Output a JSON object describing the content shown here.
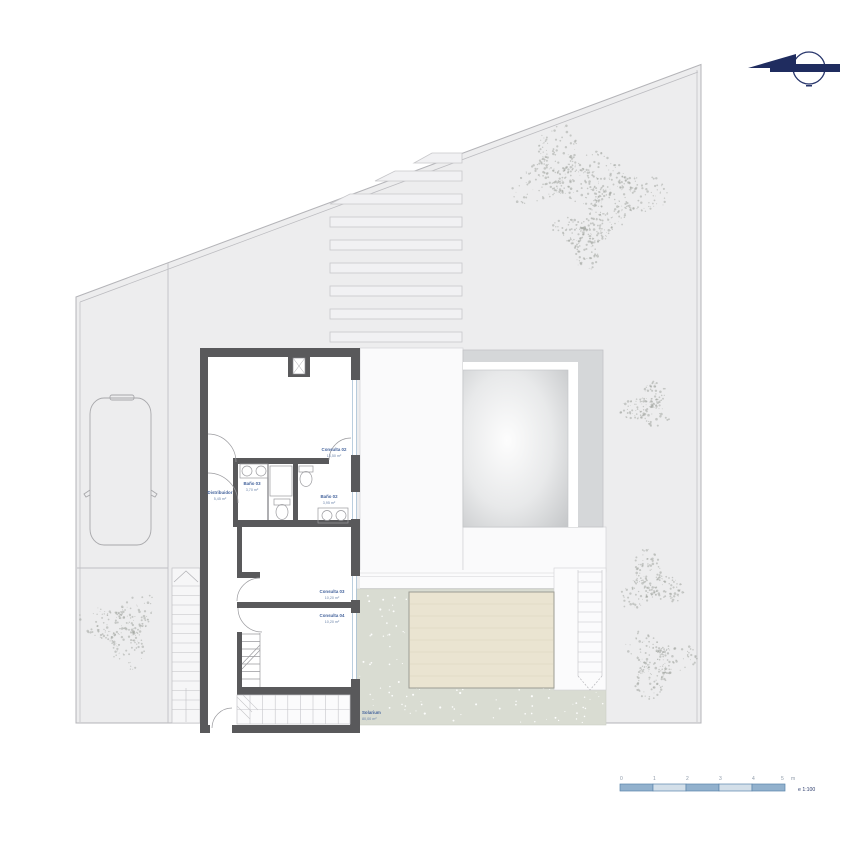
{
  "rooms": [
    {
      "id": "consulta-02",
      "name": "Consulta 02",
      "area": "13,50 m²"
    },
    {
      "id": "bano-03",
      "name": "Baño 03",
      "area": "3,70 m²"
    },
    {
      "id": "distribuidor",
      "name": "Distribuidor",
      "area": "5,45 m²"
    },
    {
      "id": "bano-02",
      "name": "Baño 02",
      "area": "3,95 m²"
    },
    {
      "id": "consulta-03",
      "name": "Consulta 03",
      "area": "10,20 m²"
    },
    {
      "id": "consulta-04",
      "name": "Consulta 04",
      "area": "10,20 m²"
    },
    {
      "id": "solarium",
      "name": "Solarium",
      "area": "80,00 m²"
    }
  ],
  "scale_bar": {
    "tick_labels": [
      "0",
      "1",
      "2",
      "3",
      "4",
      "5"
    ],
    "unit_label": "m",
    "scale_label": "e 1:100"
  },
  "icons": {
    "north_arrow": "north-arrow-icon"
  },
  "colors": {
    "wall_gray": "#59595b",
    "site_gray": "#ededee",
    "ground_green": "#d9dcd2",
    "pool_beige": "#eae4d1",
    "label_blue": "#4a6fa5",
    "navy_accent": "#222f60",
    "scale_dark": "#92b1cd",
    "scale_light": "#d3dfe9"
  }
}
